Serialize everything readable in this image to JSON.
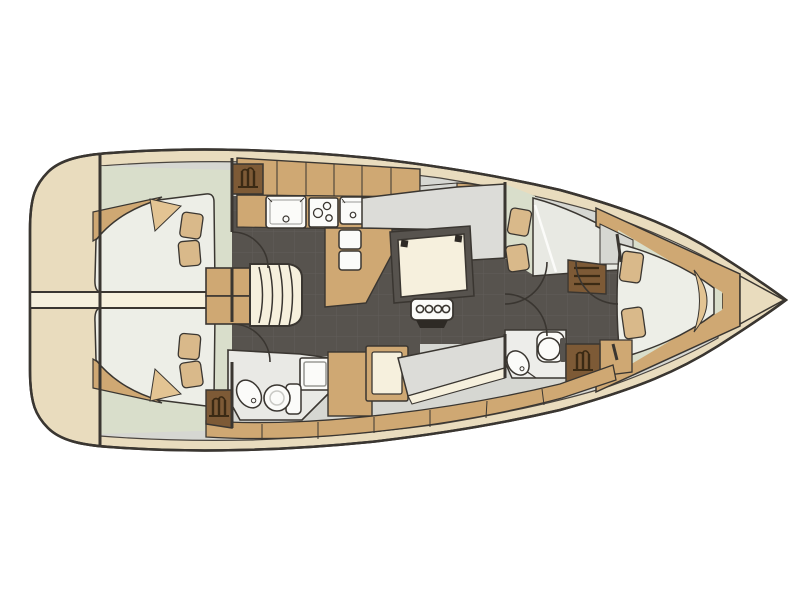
{
  "meta": {
    "title": "Sailing yacht interior floor plan (top view, bow to the right)",
    "diagram_type": "boat-floor-plan"
  },
  "palette": {
    "background": "#ffffff",
    "hull_deck_beige": "#e9dcbe",
    "wood_tan": "#cfa873",
    "wood_tan_light": "#e3c493",
    "locker_brown": "#7d5a36",
    "icon_dark_brown": "#3b2a14",
    "floor_dark": "#57534e",
    "floor_grid_line": "#625e59",
    "seat_gray": "#dcdcd8",
    "inner_gray": "#d6d7d2",
    "cabin_sage": "#d9decb",
    "bed_white": "#edeee7",
    "cream": "#f6f0dd",
    "fixture_white": "#fbfbf9",
    "outline": "#3a3631"
  },
  "regions": [
    {
      "label": "Transom / swim platform",
      "side": "aft"
    },
    {
      "label": "Aft owner cabin with twin fan-shaped berths and pillows"
    },
    {
      "label": "Companionway stairs"
    },
    {
      "label": "Galley with two sinks, three-burner stove and two top-loading fridge boxes"
    },
    {
      "label": "Saloon with dark teak floor and folding table with bottle holder"
    },
    {
      "label": "Upper settee"
    },
    {
      "label": "Aft head with toilet, basin and shower pan"
    },
    {
      "label": "Navigation seat and chart locker"
    },
    {
      "label": "Guest cabin with double berth and pillows"
    },
    {
      "label": "Forward head with toilet and basin"
    },
    {
      "label": "Hanging lockers marked with coat-hanger symbols"
    },
    {
      "label": "Bow V-berth cabin with pillows"
    },
    {
      "label": "Anchor locker at bow tip"
    }
  ],
  "icons": [
    {
      "name": "hanger-icon",
      "meaning": "hanging locker / wardrobe"
    },
    {
      "name": "drawer-icon",
      "meaning": "shelves or drawers"
    },
    {
      "name": "burner-icon",
      "meaning": "stove burners"
    },
    {
      "name": "bottle-holder-icon",
      "meaning": "four-bottle holder at saloon table"
    }
  ]
}
